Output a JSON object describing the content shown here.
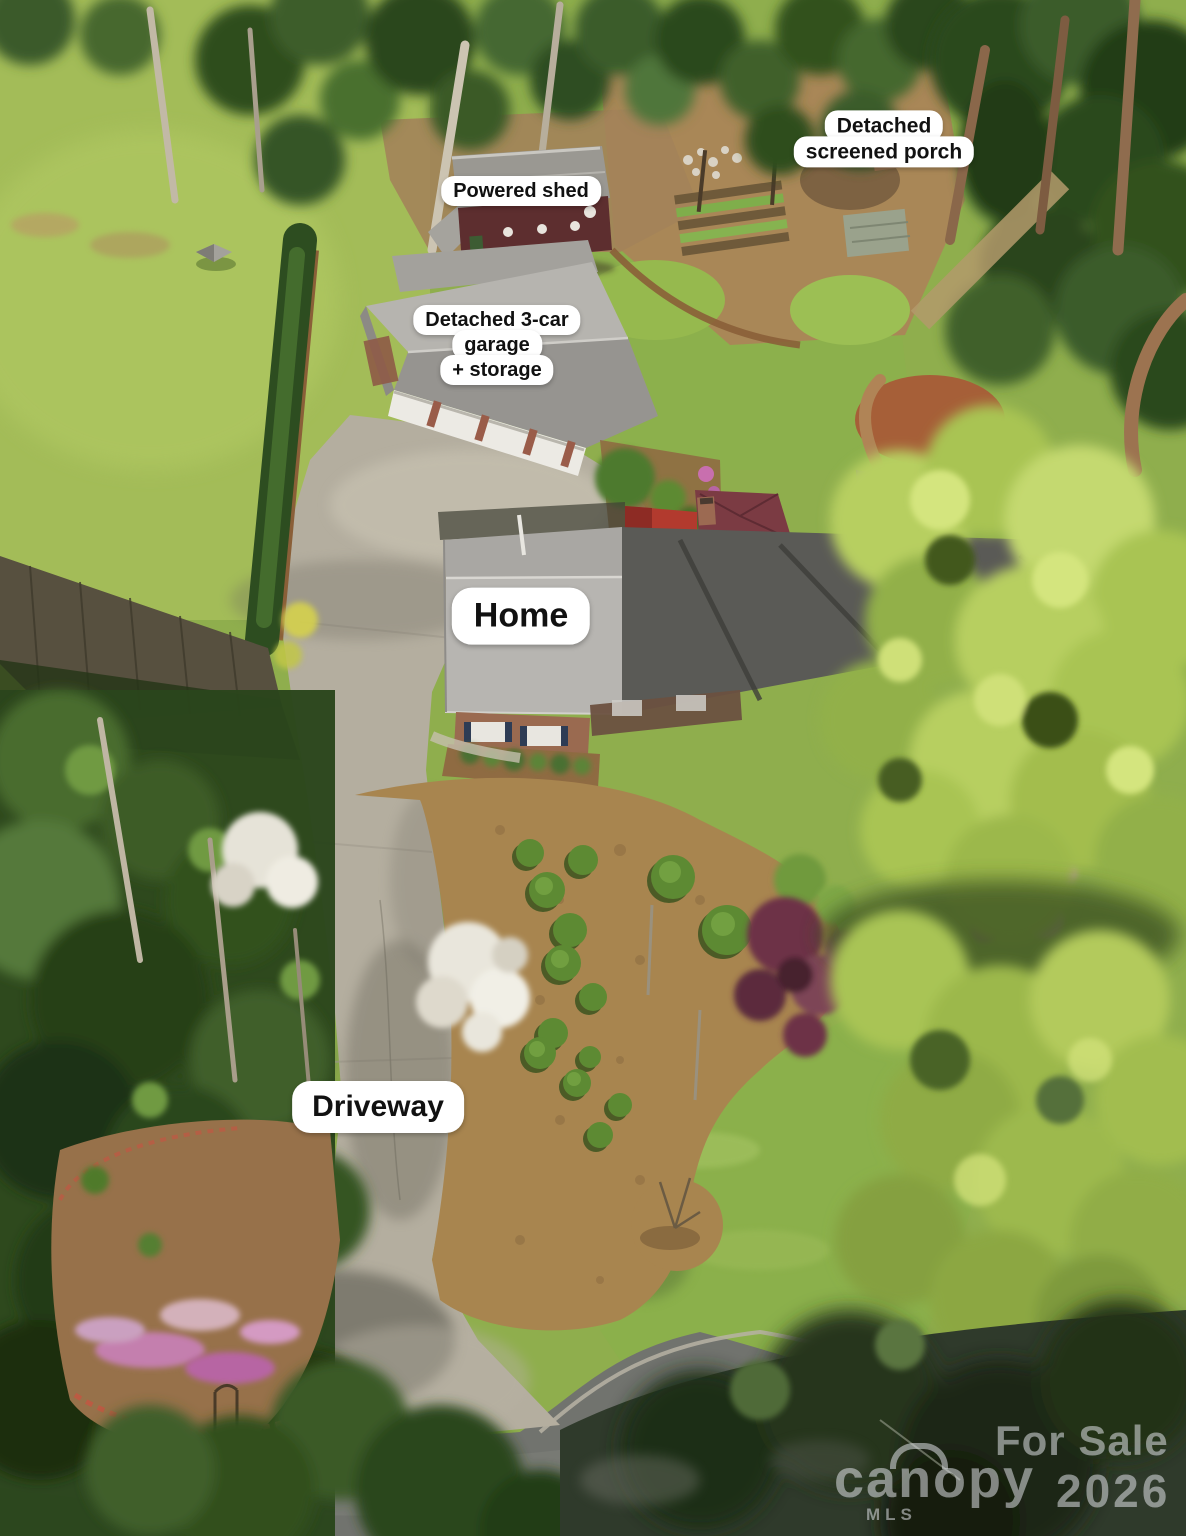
{
  "labels": {
    "porch": {
      "line1": "Detached",
      "line2": "screened porch"
    },
    "shed": {
      "text": "Powered shed"
    },
    "garage": {
      "line1": "Detached 3-car",
      "line2": "garage",
      "line3": "+ storage"
    },
    "home": {
      "text": "Home"
    },
    "driveway": {
      "text": "Driveway"
    }
  },
  "watermark": {
    "for_sale": "For Sale",
    "year": "2026",
    "brand": "canopy",
    "brand_sub": "MLS"
  },
  "colors": {
    "label_bg": "#ffffff",
    "label_text": "#111111",
    "watermark_text": "#dfe0e5",
    "lawn": "#8fae4d",
    "mulch": "#a8854f",
    "roof_gray": "#b7b5b1",
    "shed_wall_maroon": "#5d2e2f",
    "red_roof": "#b23a2e",
    "brick": "#9a6a50",
    "asphalt": "#71736e",
    "concrete": "#b4ae9f"
  }
}
